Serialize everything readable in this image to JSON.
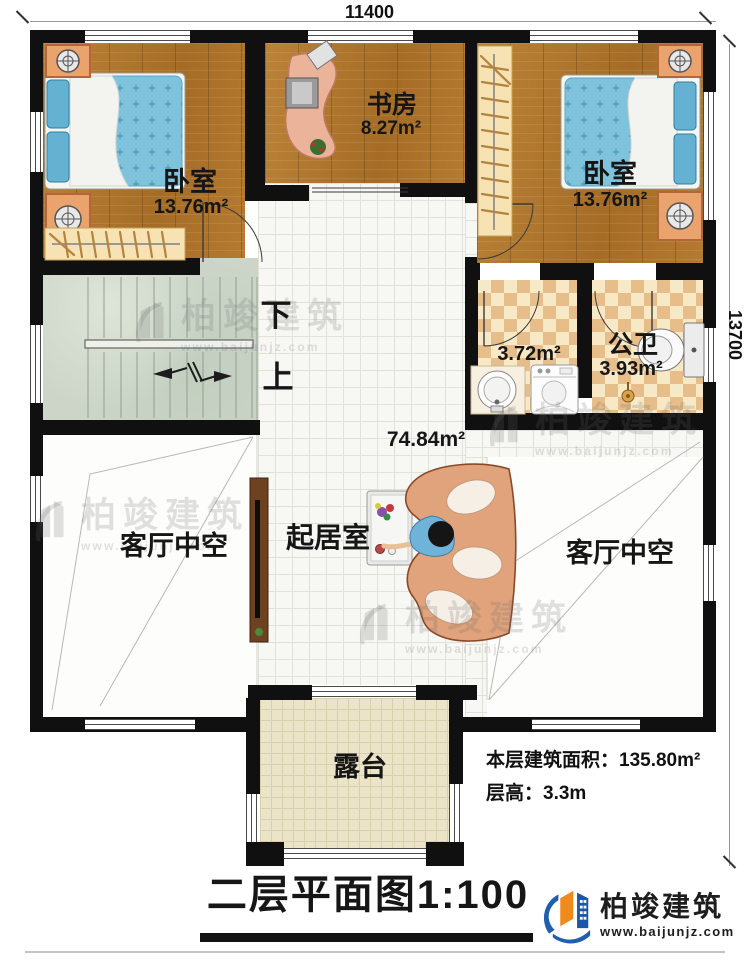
{
  "dimensions": {
    "width": "11400",
    "height": "13700"
  },
  "title": "二层平面图1:100",
  "rooms": {
    "bedroom_left": {
      "name": "卧室",
      "area": "13.76m²"
    },
    "study": {
      "name": "书房",
      "area": "8.27m²"
    },
    "bedroom_right": {
      "name": "卧室",
      "area": "13.76m²"
    },
    "washroom": {
      "area": "3.72m²"
    },
    "toilet": {
      "name": "公卫",
      "area": "3.93m²"
    },
    "living": {
      "name": "起居室",
      "area": "74.84m²"
    },
    "void_left": {
      "name": "客厅中空"
    },
    "void_right": {
      "name": "客厅中空"
    },
    "terrace": {
      "name": "露台"
    }
  },
  "stairs": {
    "down_label": "下",
    "up_label": "上"
  },
  "notes": {
    "area_label": "本层建筑面积：",
    "area_value": "135.80m²",
    "height_label": "层高：",
    "height_value": "3.3m"
  },
  "brand": {
    "name": "柏竣建筑",
    "url": "www.baijunjz.com"
  },
  "colors": {
    "wall": "#101010",
    "wood": "#b0772f",
    "accent_blue": "#1a57a8",
    "accent_orange": "#f08a1d"
  }
}
